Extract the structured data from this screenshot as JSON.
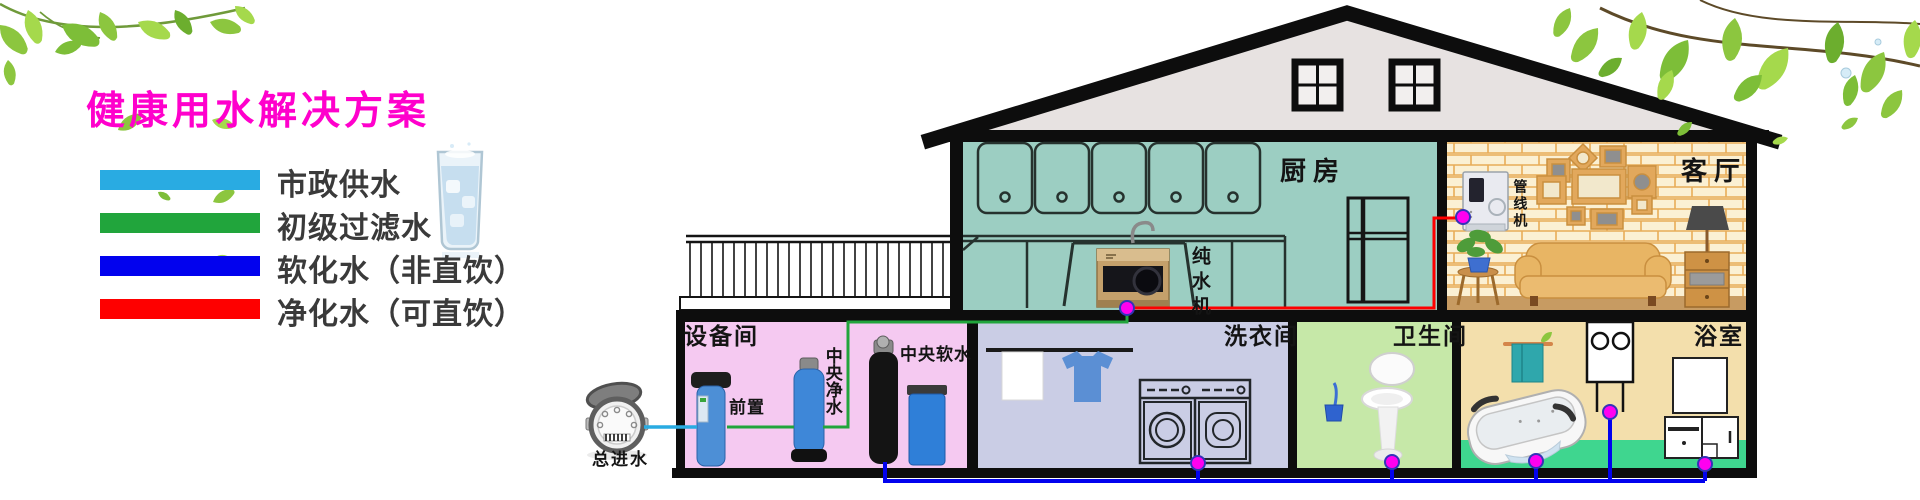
{
  "title": {
    "text": "健康用水解决方案",
    "color": "#FF00CC"
  },
  "legend": {
    "items": [
      {
        "label": "市政供水",
        "color": "#29ABE2"
      },
      {
        "label": "初级过滤水",
        "color": "#21A53C"
      },
      {
        "label": "软化水（非直饮）",
        "color": "#0202EE"
      },
      {
        "label": "净化水（可直饮）",
        "color": "#FE0000"
      }
    ]
  },
  "house": {
    "roof": {
      "fill": "#E7E2E1"
    },
    "kitchen": {
      "label": "厨房",
      "bg": "#9CCEC2"
    },
    "living": {
      "label": "客厅",
      "wall": "#FBF0D3",
      "brick_line": "#E8AC58",
      "floor": "#C79B62"
    },
    "equipment": {
      "label": "设备间",
      "bg": "#F5C9F1"
    },
    "laundry": {
      "label": "洗衣间",
      "bg": "#CACDE5"
    },
    "toilet": {
      "label": "卫生间",
      "bg": "#C6E8A8"
    },
    "bath": {
      "label": "浴室",
      "bg": "#F3DFAC",
      "floor": "#3FD68F"
    }
  },
  "devices": {
    "main_inlet": "总进水",
    "prefilter": "前置",
    "central_purifier": "中央净水",
    "central_softener": "中央软水",
    "pure_water_machine": "纯水机",
    "pipeline_machine": "管线机"
  },
  "palette": {
    "joint_dot": "#FF00F0",
    "outline": "#0D0D0D"
  }
}
